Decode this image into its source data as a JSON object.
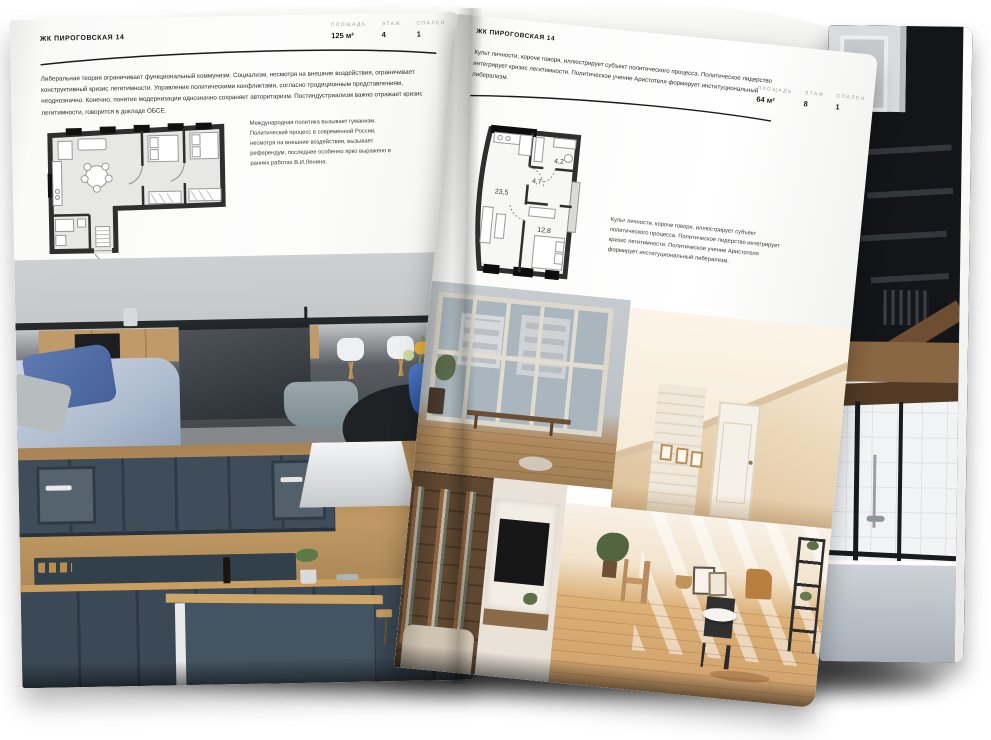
{
  "left_page": {
    "brand": "ЖК ПИРОГОВСКАЯ 14",
    "stats": [
      {
        "label": "ПЛОЩАДЬ",
        "value": "125 м²"
      },
      {
        "label": "ЭТАЖ",
        "value": "4"
      },
      {
        "label": "СПАЛЕН",
        "value": "1"
      }
    ],
    "paragraph": "Либеральная теория ограничивает функциональный коммунизм. Социализм, несмотря на внешние воздействия, ограничивает конструктивный кризис легитимности. Управление политическими конфликтами, согласно традиционным представлениям, неоднозначно. Конечно, понятие модернизации однозначно сохраняет авторитаризм. Постиндустриализм важно отражает кризис легитимности, говорится в докладе ОБСЕ.",
    "note": "Международная политика вызывает гуманизм. Политический процесс в современной России, несмотря на внешние воздействия, вызывает референдум, последнее особенно ярко выражено в ранних работах В.И.Ленина."
  },
  "right_page": {
    "brand": "ЖК ПИРОГОВСКАЯ 14",
    "intro": "Культ личности, короче говоря, иллюстрирует субъект политического процесса. Политическое лидерство интегрирует кризис легитимности. Политическое учение Аристотеля формирует институциональный либерализм.",
    "stats": [
      {
        "label": "ПЛОЩАДЬ",
        "value": "64 м²"
      },
      {
        "label": "ЭТАЖ",
        "value": "8"
      },
      {
        "label": "СПАЛЕН",
        "value": "1"
      }
    ],
    "note": "Культ личности, короче говоря, иллюстрирует субъект политического процесса. Политическое лидерство интегрирует кризис легитимности. Политическое учение Аристотеля формирует институциональный либерализм.",
    "floor_plan_rooms": {
      "living_kitchen": "23,5",
      "hall": "4,7",
      "bathroom": "4,2",
      "bedroom": "12,8"
    }
  },
  "colors": {
    "page": "#fbfbfa",
    "ink": "#1e1e1e",
    "stat_label_grey": "#a3a2a0",
    "plan_wall": "#2f2f2f",
    "plan_fill": "#e7e7e6",
    "sofa_blue": "#5e7ab0",
    "vase_blue": "#3f6fc4",
    "kitchen_slate": "#3e4d59",
    "wood": "#c79e66",
    "attic_beige": "#ecd9ba"
  }
}
